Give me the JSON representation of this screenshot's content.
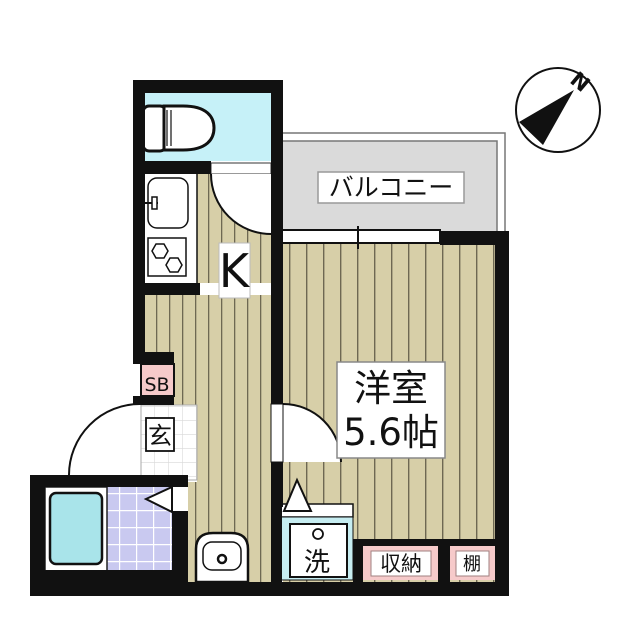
{
  "floor_plan": {
    "compass": {
      "north_label": "N"
    },
    "balcony": {
      "label": "バルコニー"
    },
    "kitchen": {
      "label": "K"
    },
    "main_room": {
      "name": "洋室",
      "size": "5.6帖"
    },
    "entrance": {
      "label": "玄"
    },
    "shoe_box": {
      "label": "SB"
    },
    "laundry": {
      "label": "洗"
    },
    "closet": {
      "label": "収納"
    },
    "shelf": {
      "label": "棚"
    }
  },
  "colors": {
    "wall": "#111111",
    "wood_floor": "#d7cfa8",
    "wood_stripe": "#6e6852",
    "toilet_floor": "#c6f1f8",
    "bathtub": "#a9e4ea",
    "laundry_box": "#c6edf1",
    "bath_tile": "#c9c9f0",
    "entry_tile_line": "#cccccc",
    "balcony": "#dadada",
    "pink_label": "#f6caca"
  }
}
